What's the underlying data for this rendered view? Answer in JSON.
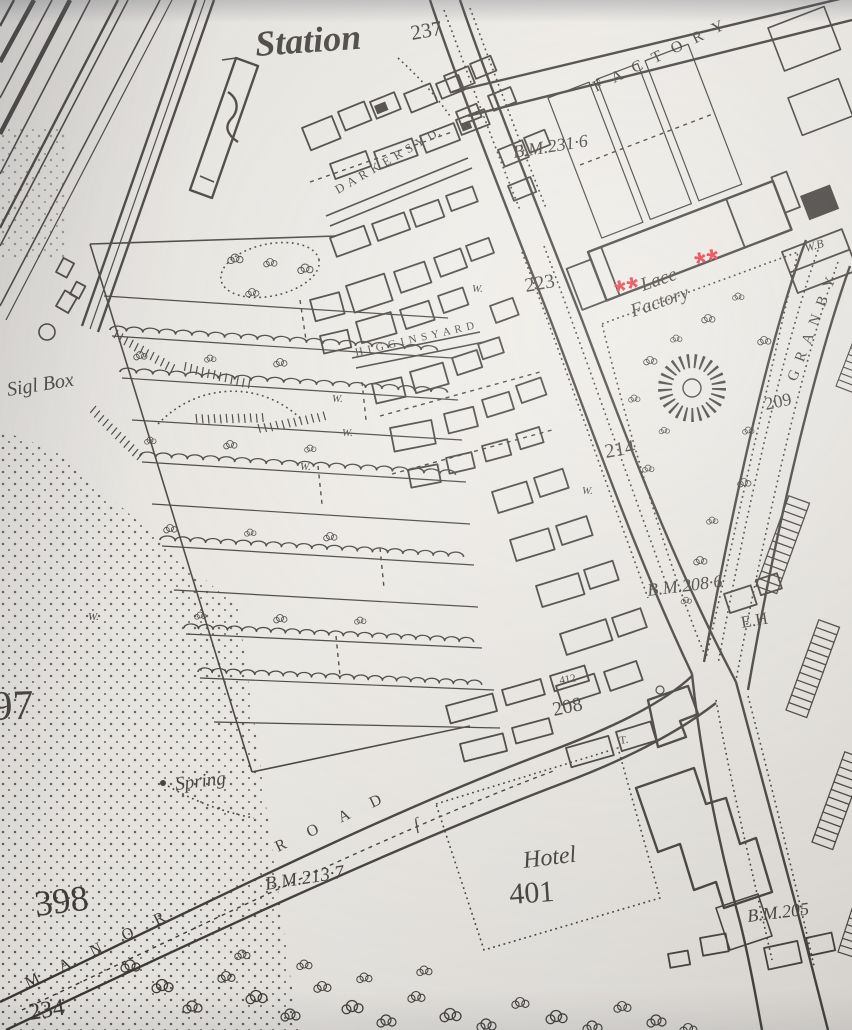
{
  "colors": {
    "paper": "#eae7e1",
    "ink": "#2a2622",
    "red_annotation": "#e7232c"
  },
  "labels": {
    "station": "Station",
    "h237": "237",
    "factory": "F A C T O R Y",
    "bm231": "B.M.231·6",
    "darkers_yd": "D A R K E R S  Y D.",
    "h223": "223",
    "lace_line1": "Lace",
    "lace_line2": "Factory",
    "granby": "G R A N B Y",
    "h209": "209",
    "sig_box": "Sigl Box",
    "h214": "214",
    "bm208": "B.M.208·6",
    "eh": "E.H",
    "h208": "208",
    "h97": "97",
    "spring": "Spring",
    "h398": "398",
    "bm213": "B.M.213·7",
    "hotel": "Hotel",
    "h401": "401",
    "manor": "M A N O R",
    "road_word": "R O A D",
    "h234": "234",
    "bm205": "B.M.205",
    "wb": "W.B",
    "yard2": "H I G G I N S  Y A R D",
    "h412": "412",
    "t_mark": "T.",
    "long_s": "ſ",
    "well": "W."
  },
  "annotations": {
    "red_marks": [
      "**",
      "**"
    ]
  }
}
